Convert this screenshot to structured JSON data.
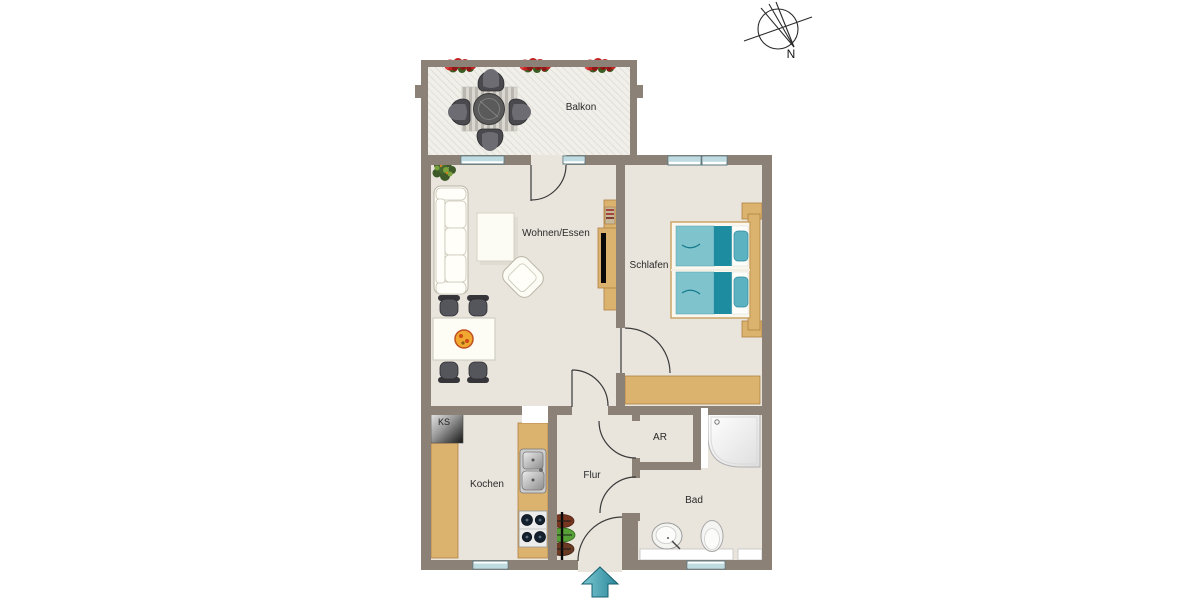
{
  "rooms": {
    "balcony": {
      "label": "Balkon"
    },
    "living": {
      "label": "Wohnen/Essen"
    },
    "bedroom": {
      "label": "Schlafen"
    },
    "kitchen": {
      "label": "Kochen"
    },
    "hallway": {
      "label": "Flur"
    },
    "storage": {
      "label": "AR"
    },
    "bathroom": {
      "label": "Bad"
    }
  },
  "labels": {
    "fridge": "KS",
    "north": "N"
  },
  "colors": {
    "wall": "#8b8177",
    "floor": "#e9e5dd",
    "balcony_floor": "#f0efe9",
    "hatch_line": "#d6d3ca",
    "wood": "#dcb26f",
    "wood_stroke": "#b1813f",
    "window_fill": "#bedbe1",
    "window_stroke": "#5b7a83",
    "door_line": "#3a3a3a",
    "teal_dark": "#1d8ba0",
    "teal_light": "#7fc3cd",
    "pillow_teal": "#5cb2c1",
    "arrow_fill": "#4aa9ba",
    "arrow_stroke": "#17616f",
    "furniture_white": "#fdfcf4",
    "furniture_stroke": "#b8b4a6",
    "chair_dark": "#4a4a4e",
    "label_color": "#2a2a2a"
  }
}
